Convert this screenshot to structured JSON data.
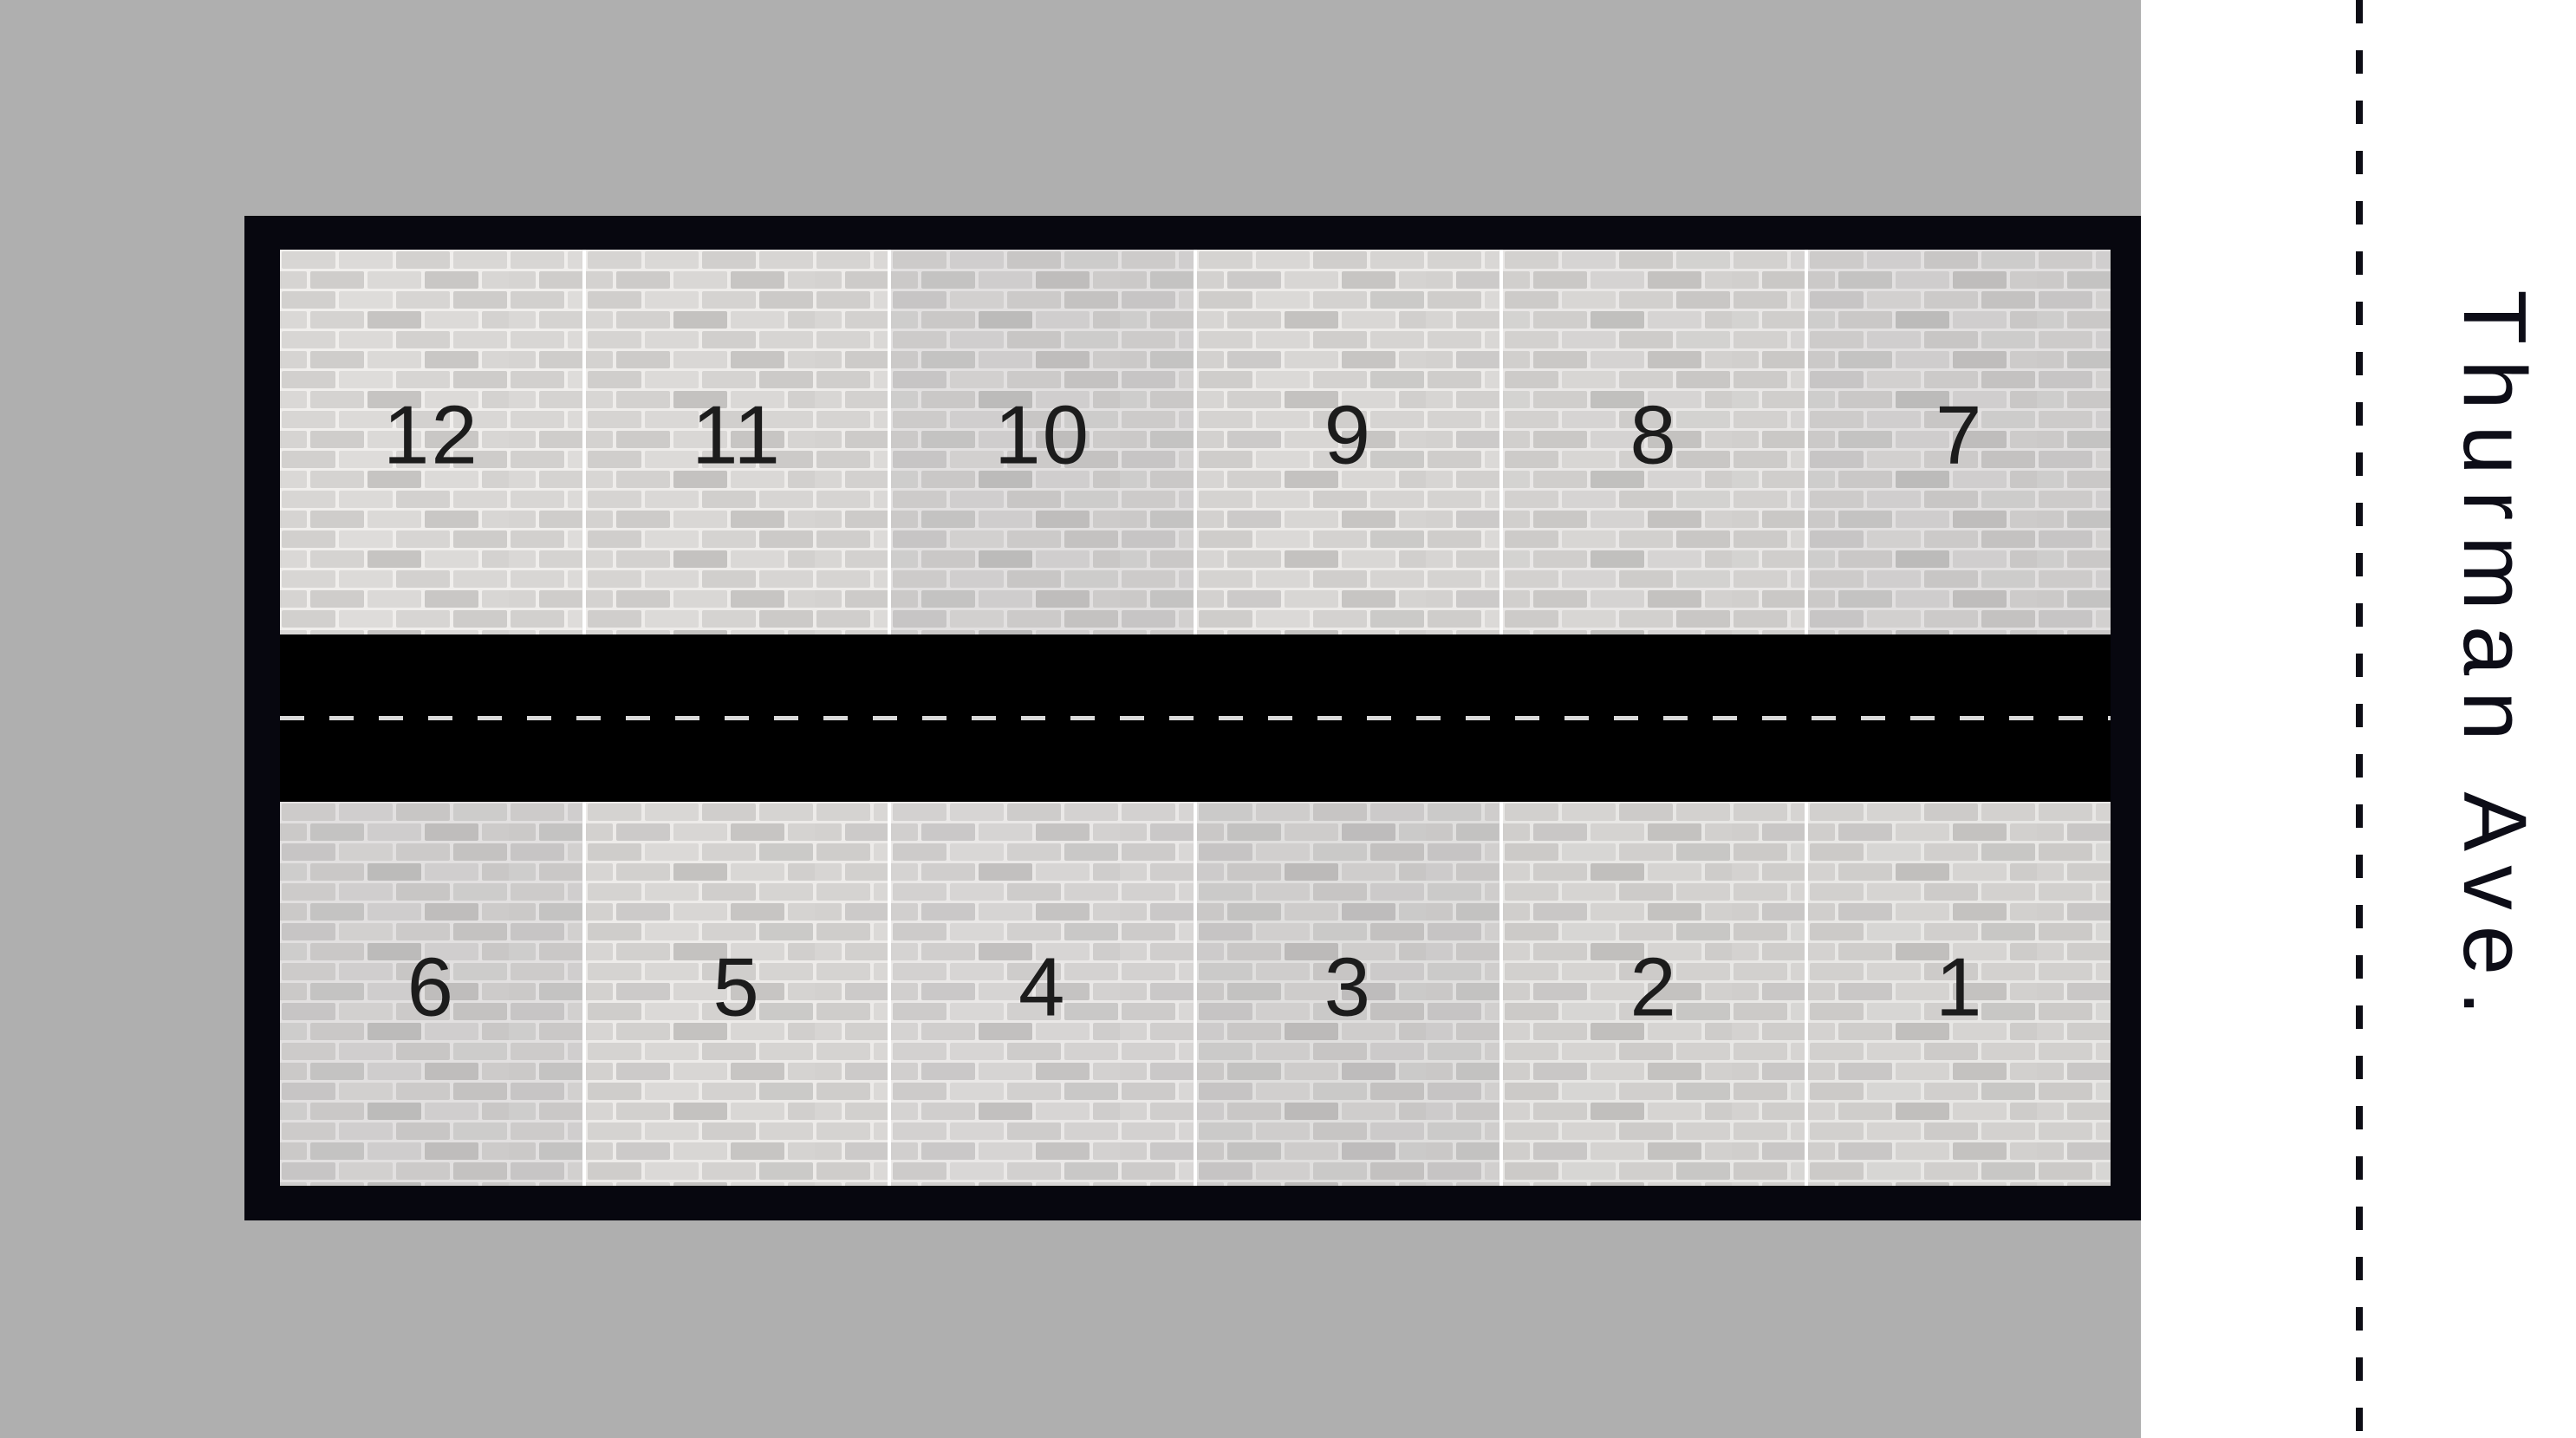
{
  "street": {
    "label": "Thurman Ave."
  },
  "facility": {
    "rows": [
      {
        "id": "north-row",
        "units": [
          {
            "number": "12",
            "shade": 0.0
          },
          {
            "number": "11",
            "shade": 0.01
          },
          {
            "number": "10",
            "shade": 0.1
          },
          {
            "number": "9",
            "shade": 0.02
          },
          {
            "number": "8",
            "shade": 0.05
          },
          {
            "number": "7",
            "shade": 0.1
          }
        ]
      },
      {
        "id": "south-row",
        "units": [
          {
            "number": "6",
            "shade": 0.1
          },
          {
            "number": "5",
            "shade": 0.02
          },
          {
            "number": "4",
            "shade": 0.04
          },
          {
            "number": "3",
            "shade": 0.12
          },
          {
            "number": "2",
            "shade": 0.06
          },
          {
            "number": "1",
            "shade": 0.06
          }
        ]
      }
    ]
  },
  "colors": {
    "page_background": "#ffffff",
    "land": "#afafaf",
    "frame": "#07070f",
    "driveway": "#000000",
    "lane_dash": "#d9d9d9",
    "boundary_dash": "#0d0d15",
    "unit_number": "#1c1c1c",
    "street_text": "#0d0d17",
    "unit_divider": "#ffffff"
  }
}
